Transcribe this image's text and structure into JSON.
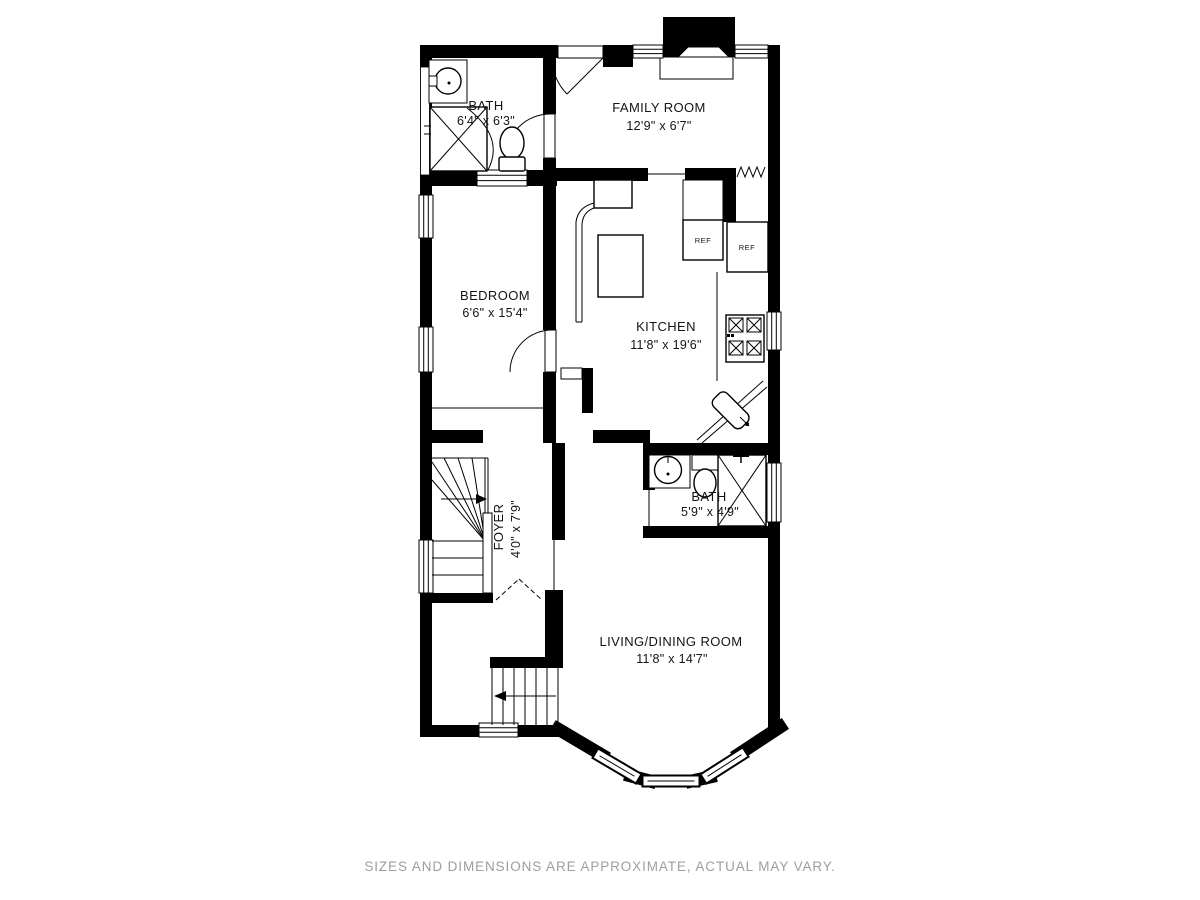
{
  "floor_plan": {
    "rooms": [
      {
        "name": "BATH",
        "dims": "6'4\" x 6'3\""
      },
      {
        "name": "FAMILY ROOM",
        "dims": "12'9\" x 6'7\""
      },
      {
        "name": "BEDROOM",
        "dims": "6'6\" x 15'4\""
      },
      {
        "name": "KITCHEN",
        "dims": "11'8\" x 19'6\""
      },
      {
        "name": "FOYER",
        "dims": "4'0\" x 7'9\""
      },
      {
        "name": "BATH",
        "dims": "5'9\" x 4'9\""
      },
      {
        "name": "LIVING/DINING ROOM",
        "dims": "11'8\" x 14'7\""
      }
    ],
    "appliance_labels": {
      "refrigerator_1": "REF",
      "refrigerator_2": "REF"
    },
    "colors": {
      "walls": "#000000",
      "background": "#ffffff",
      "room_label": "#141414",
      "disclaimer": "#9e9e9e"
    }
  },
  "footer": {
    "disclaimer": "SIZES AND DIMENSIONS ARE APPROXIMATE, ACTUAL MAY VARY."
  }
}
